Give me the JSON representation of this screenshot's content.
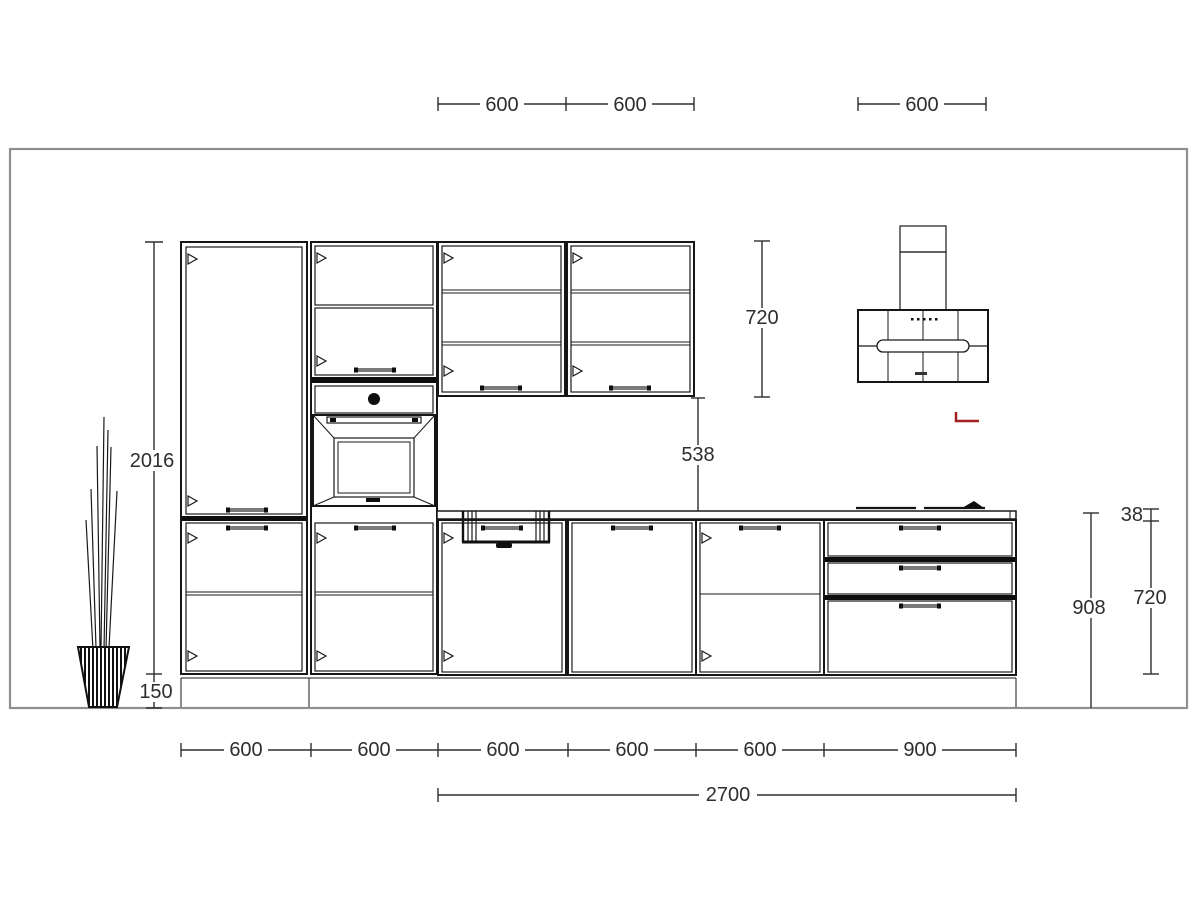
{
  "dims": {
    "top": [
      "600",
      "600",
      "600"
    ],
    "left": {
      "height": "2016",
      "plinth": "150"
    },
    "wall": {
      "height": "720",
      "splashback": "538"
    },
    "right": {
      "counter_height": "908",
      "worktop_thickness": "38",
      "base_height": "720"
    },
    "bottom": [
      "600",
      "600",
      "600",
      "600",
      "600",
      "900"
    ],
    "total": "2700"
  },
  "colors": {
    "line": "#1a1a1a",
    "room_outline": "#8f8f8f",
    "handle_gray": "#7a7a7a",
    "annotation_red": "#a32020",
    "dim_text": "#2e2e2e"
  }
}
